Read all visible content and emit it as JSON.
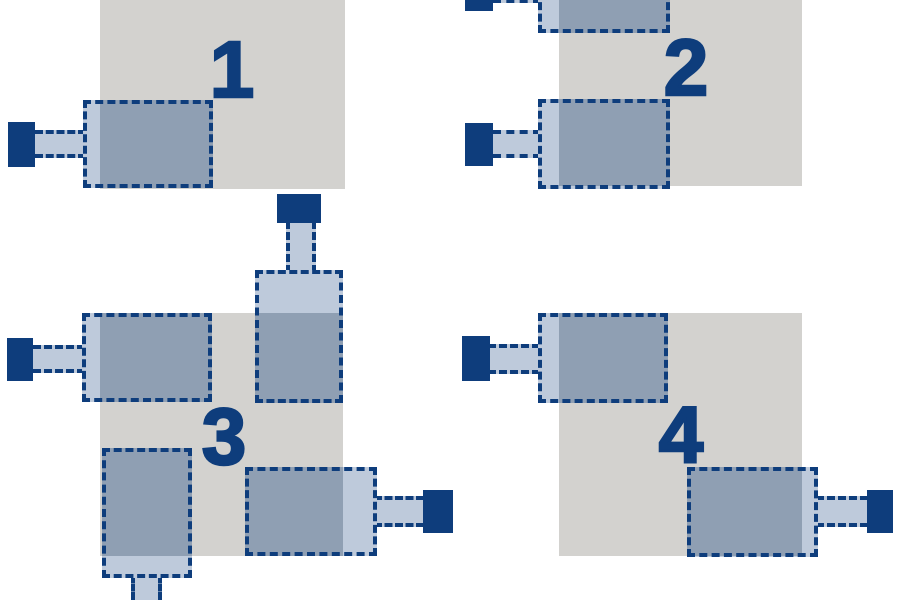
{
  "colors": {
    "background": "#ffffff",
    "board_square": "#d3d2cf",
    "machine_fill": "#becadb",
    "machine_overlap_fill": "#8f9fb3",
    "outline": "#0e3d7c",
    "number": "#0e3d7c"
  },
  "canvas": {
    "width": 900,
    "height": 600
  },
  "panels": [
    {
      "number": "1",
      "number_pos": {
        "x": 231,
        "y": 70
      },
      "board": {
        "x": 100,
        "y": -56,
        "w": 245,
        "h": 245
      },
      "units": [
        {
          "rect": {
            "x": 83,
            "y": 100,
            "w": 130,
            "h": 88
          },
          "arm": {
            "x": 35,
            "y": 130,
            "w": 51,
            "h": 28,
            "dir": "h"
          },
          "plug": {
            "x": 8,
            "y": 122,
            "w": 27,
            "h": 45
          }
        }
      ]
    },
    {
      "number": "2",
      "number_pos": {
        "x": 685,
        "y": 68
      },
      "board": {
        "x": 559,
        "y": -57,
        "w": 243,
        "h": 243
      },
      "units": [
        {
          "rect": {
            "x": 538,
            "y": -55,
            "w": 132,
            "h": 88
          },
          "arm": {
            "x": 493,
            "y": -26,
            "w": 48,
            "h": 29,
            "dir": "h"
          },
          "plug": {
            "x": 465,
            "y": -34,
            "w": 28,
            "h": 45
          }
        },
        {
          "rect": {
            "x": 538,
            "y": 99,
            "w": 132,
            "h": 90
          },
          "arm": {
            "x": 493,
            "y": 130,
            "w": 48,
            "h": 28,
            "dir": "h"
          },
          "plug": {
            "x": 465,
            "y": 123,
            "w": 28,
            "h": 43
          }
        }
      ]
    },
    {
      "number": "3",
      "number_pos": {
        "x": 223,
        "y": 437
      },
      "board": {
        "x": 100,
        "y": 313,
        "w": 243,
        "h": 243
      },
      "units": [
        {
          "rect": {
            "x": 82,
            "y": 313,
            "w": 130,
            "h": 89
          },
          "arm": {
            "x": 33,
            "y": 345,
            "w": 52,
            "h": 28,
            "dir": "h"
          },
          "plug": {
            "x": 7,
            "y": 338,
            "w": 26,
            "h": 43
          }
        },
        {
          "rect": {
            "x": 255,
            "y": 270,
            "w": 88,
            "h": 133
          },
          "arm": {
            "x": 286,
            "y": 221,
            "w": 30,
            "h": 52,
            "dir": "v"
          },
          "plug": {
            "x": 277,
            "y": 194,
            "w": 44,
            "h": 29
          }
        },
        {
          "rect": {
            "x": 102,
            "y": 448,
            "w": 90,
            "h": 130
          },
          "arm": {
            "x": 131,
            "y": 575,
            "w": 31,
            "h": 25,
            "dir": "v"
          }
        },
        {
          "rect": {
            "x": 245,
            "y": 467,
            "w": 132,
            "h": 89
          },
          "arm": {
            "x": 374,
            "y": 496,
            "w": 50,
            "h": 31,
            "dir": "h"
          },
          "plug": {
            "x": 423,
            "y": 490,
            "w": 30,
            "h": 43
          }
        }
      ]
    },
    {
      "number": "4",
      "number_pos": {
        "x": 680,
        "y": 435
      },
      "board": {
        "x": 559,
        "y": 313,
        "w": 243,
        "h": 243
      },
      "units": [
        {
          "rect": {
            "x": 538,
            "y": 313,
            "w": 130,
            "h": 90
          },
          "arm": {
            "x": 488,
            "y": 344,
            "w": 52,
            "h": 30,
            "dir": "h"
          },
          "plug": {
            "x": 462,
            "y": 336,
            "w": 28,
            "h": 45
          }
        },
        {
          "rect": {
            "x": 687,
            "y": 467,
            "w": 131,
            "h": 90
          },
          "arm": {
            "x": 816,
            "y": 496,
            "w": 52,
            "h": 31,
            "dir": "h"
          },
          "plug": {
            "x": 867,
            "y": 490,
            "w": 26,
            "h": 43
          }
        }
      ]
    }
  ]
}
